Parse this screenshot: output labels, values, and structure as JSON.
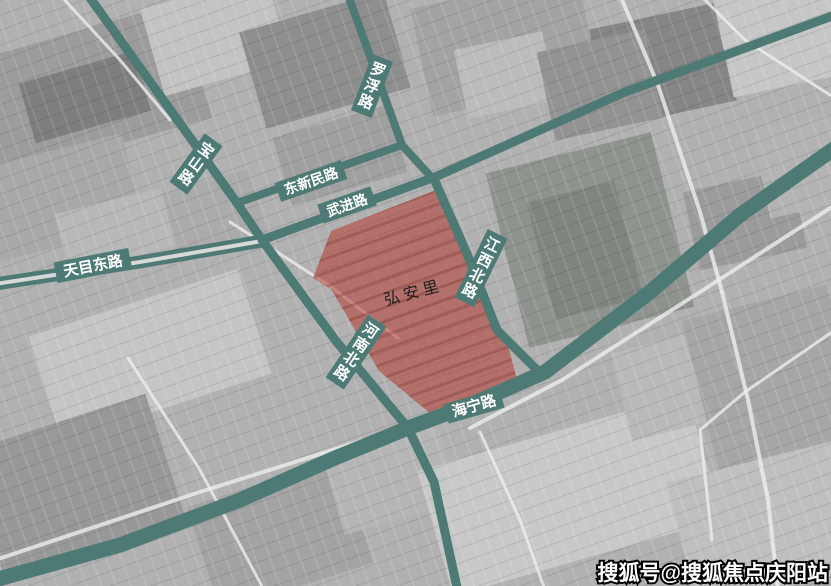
{
  "map": {
    "type": "satellite-overlay-map",
    "area": {
      "label": "弘安里"
    },
    "roads": [
      {
        "id": "baoshan",
        "label": "宝山路",
        "orientation": "vertical"
      },
      {
        "id": "luofu",
        "label": "罗浮路",
        "orientation": "vertical"
      },
      {
        "id": "dongxinmin",
        "label": "东新民路",
        "orientation": "horizontal"
      },
      {
        "id": "wujin",
        "label": "武进路",
        "orientation": "horizontal"
      },
      {
        "id": "tianmudong",
        "label": "天目东路",
        "orientation": "horizontal"
      },
      {
        "id": "jiangxibei",
        "label": "江西北路",
        "orientation": "vertical"
      },
      {
        "id": "henanbei",
        "label": "河南北路",
        "orientation": "vertical"
      },
      {
        "id": "haining",
        "label": "海宁路",
        "orientation": "horizontal"
      }
    ],
    "colors": {
      "road": "#4e7a75",
      "highlight": "#b5342a",
      "label_text": "#ffffff"
    }
  },
  "watermark": {
    "text": "搜狐号@搜狐焦点庆阳站"
  }
}
